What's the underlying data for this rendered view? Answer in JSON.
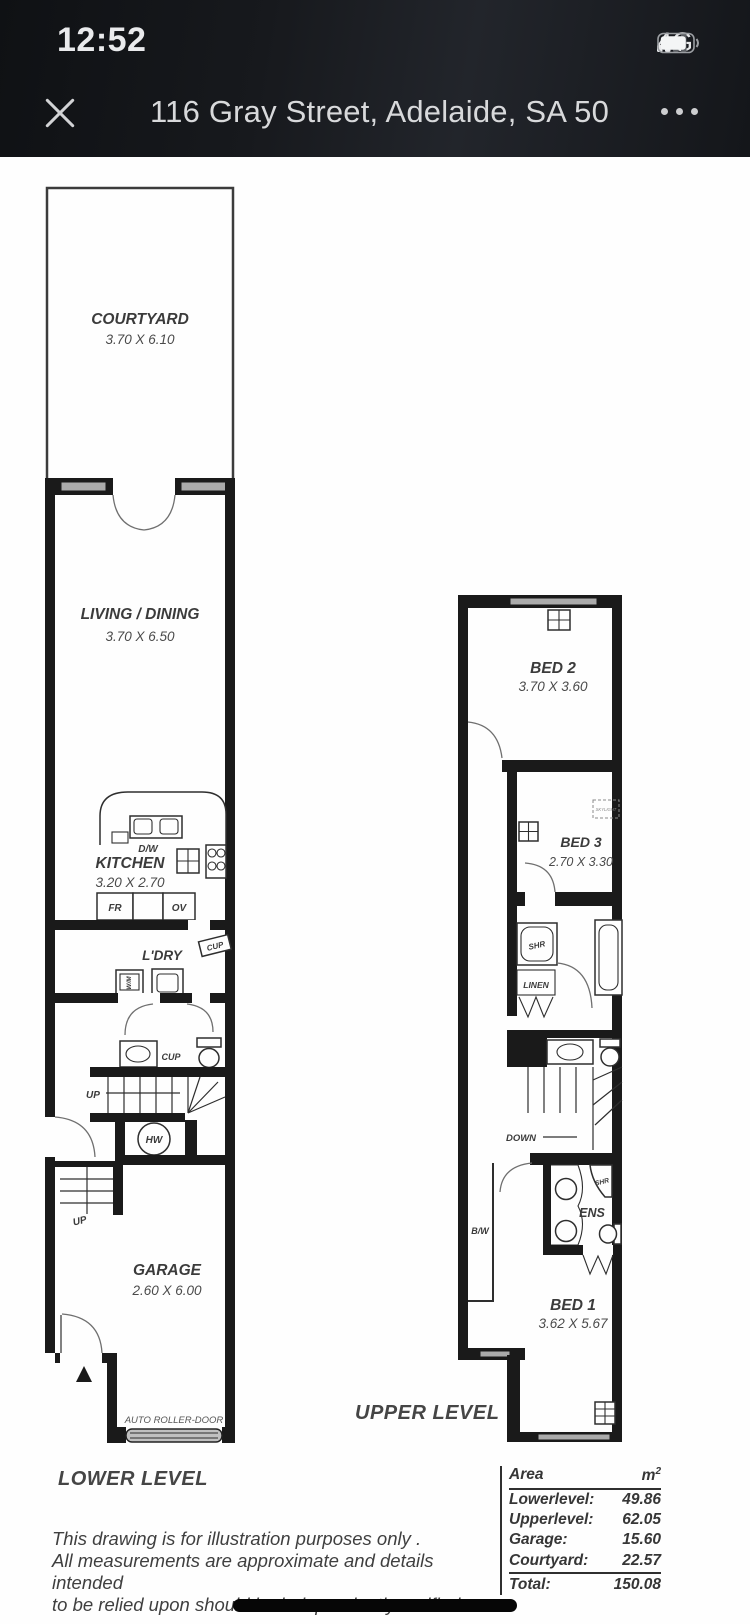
{
  "status_bar": {
    "time": "12:52",
    "network": "4G",
    "signal_bars_filled": 2,
    "signal_bars_total": 4,
    "battery_level_fraction": 0.8
  },
  "nav": {
    "title": "116 Gray Street, Adelaide, SA 50"
  },
  "icons": {
    "close": "x-cross",
    "more": "three-dots",
    "battery": "battery-outline",
    "signal": "signal-bars"
  },
  "plan": {
    "lower": {
      "level_label": "LOWER LEVEL",
      "courtyard_name": "COURTYARD",
      "courtyard_dims": "3.70 X 6.10",
      "living_name": "LIVING / DINING",
      "living_dims": "3.70 X 6.50",
      "kitchen_name": "KITCHEN",
      "kitchen_dims": "3.20 X 2.70",
      "dw": "D/W",
      "fr": "FR",
      "ov": "OV",
      "ldry": "L'DRY",
      "cup_upper": "CUP",
      "wm": "W/M",
      "cup_lower": "CUP",
      "up1": "UP",
      "hw": "HW",
      "up2": "UP",
      "garage_name": "GARAGE",
      "garage_dims": "2.60 X 6.00",
      "roller": "AUTO ROLLER-DOOR"
    },
    "upper": {
      "level_label": "UPPER LEVEL",
      "bed2_name": "BED 2",
      "bed2_dims": "3.70 X 3.60",
      "bed3_name": "BED 3",
      "bed3_dims": "2.70 X 3.30",
      "skylight": "SKYLIGHT",
      "shr1": "SHR",
      "linen": "LINEN",
      "down": "DOWN",
      "bw": "B/W",
      "ens": "ENS",
      "shr2": "SHR",
      "bed1_name": "BED 1",
      "bed1_dims": "3.62 X 5.67"
    },
    "disclaimer_line1": "This drawing is for illustration purposes only .",
    "disclaimer_line2": "All measurements are approximate and details intended",
    "disclaimer_line3": "to be relied upon should be independently verified.",
    "area_table": {
      "col_area": "Area",
      "col_unit": "m",
      "col_unit_sup": "2",
      "rows": [
        {
          "label": "Lowerlevel:",
          "value": "49.86"
        },
        {
          "label": "Upperlevel:",
          "value": "62.05"
        },
        {
          "label": "Garage:",
          "value": "15.60"
        },
        {
          "label": "Courtyard:",
          "value": "22.57"
        }
      ],
      "total_label": "Total:",
      "total_value": "150.08"
    }
  }
}
